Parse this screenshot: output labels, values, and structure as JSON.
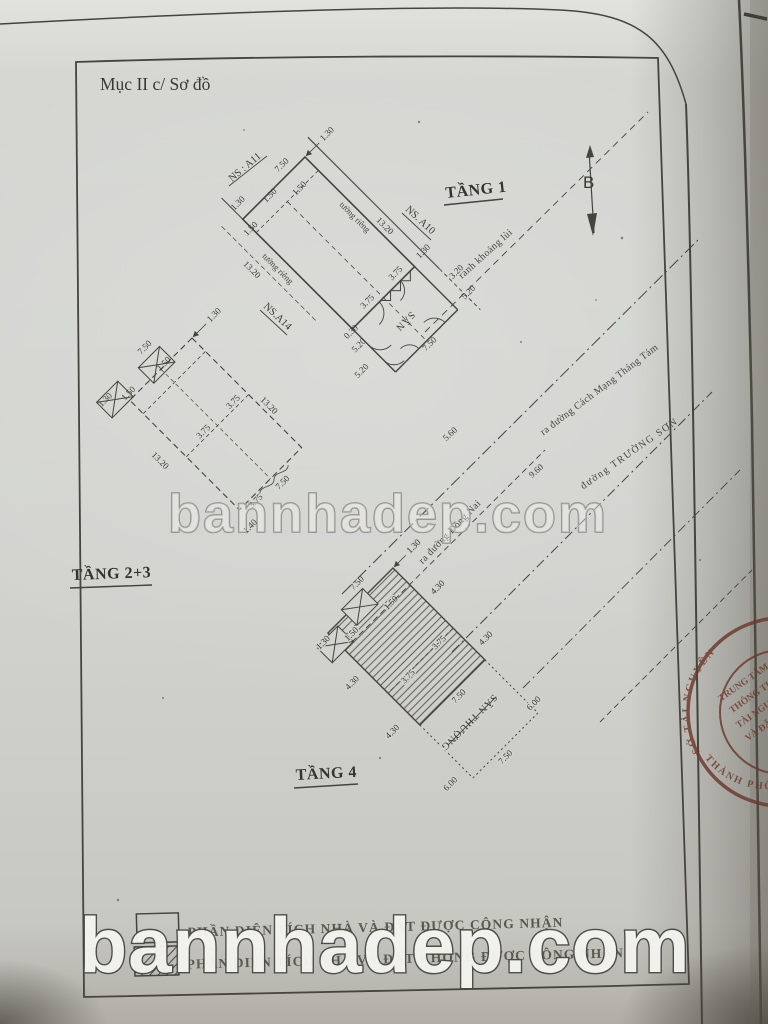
{
  "page": {
    "section_title": "Mục II c/ Sơ đồ",
    "compass_label": "B",
    "watermark_text": "bannhadep.com"
  },
  "floors": {
    "tang1": {
      "title": "TẦNG 1",
      "yard_label": "SÂN",
      "wall_label_upper": "tường riêng",
      "wall_label_lower": "tường riêng",
      "neighbor_a11": "NS : A11",
      "neighbor_a10": "NS. A10",
      "neighbor_a14": "NS.A14",
      "dims": [
        "1.30",
        "7.50",
        "1.50",
        "1.50",
        "1.30",
        "1.50",
        "13.20",
        "13.20",
        "1.30",
        "3.75",
        "3.75",
        "0.30",
        "5.20",
        "5.20",
        "5.20",
        "7.50",
        "3.20"
      ]
    },
    "tang23": {
      "title": "TẦNG 2+3",
      "dims": [
        "1.30",
        "7.50",
        "1.50",
        "1.50",
        "1.30",
        "13.20",
        "13.20",
        "3.75",
        "3.75",
        "3.75",
        "7.50",
        "1.40"
      ]
    },
    "tang4": {
      "title": "TẦNG 4",
      "terrace_label": "SÂN THƯỢNG",
      "dims": [
        "1.30",
        "7.50",
        "1.50",
        "1.50",
        "1.30",
        "4.30",
        "4.30",
        "4.30",
        "4.30",
        "3.75",
        "3.75",
        "7.50",
        "6.00",
        "6.00",
        "7.50"
      ]
    }
  },
  "site": {
    "setback_label": "ranh khoảng lùi",
    "street_cmt8": "ra đường Cách Mạng Tháng Tám",
    "street_truongson": "đường TRƯỜNG SƠN",
    "street_dongnai": "ra đường Đồng Nai",
    "dims": [
      "5.60",
      "9.60"
    ]
  },
  "legend": {
    "recognized": "PHẦN DIỆN TÍCH NHÀ VÀ ĐẤT ĐƯỢC CÔNG NHẬN",
    "not_recognized": "PHẦN DIỆN TÍCH NHÀ VÀ ĐẤT KHÔNG ĐƯỢC CÔNG NHẬN"
  },
  "stamp": {
    "ring_top": "SỞ TÀI NGUYÊN",
    "ring_bottom": "THÀNH PHỐ",
    "line1": "TRUNG TÂM",
    "line2": "THÔNG TIN",
    "line3": "TÀI NGUYÊN",
    "line4": "VÀ ĐĂNG KÝ"
  }
}
